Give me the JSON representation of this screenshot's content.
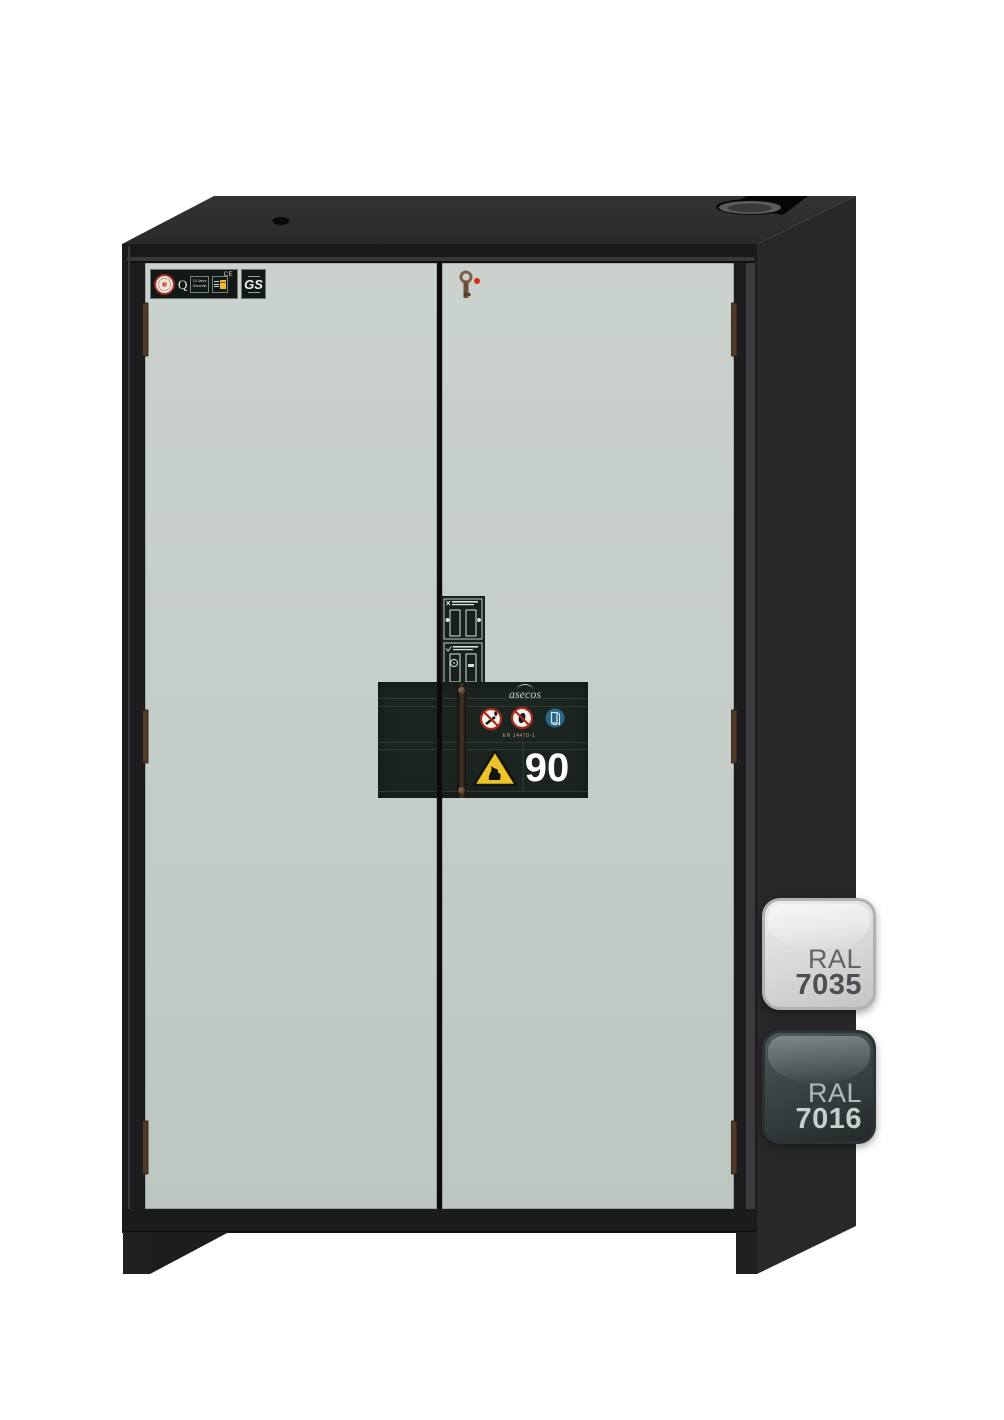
{
  "product": {
    "kind": "fire-resistant safety storage cabinet, front render on white background",
    "colors": {
      "body_anthracite": "#28282b",
      "front_frame": "#1d1d20",
      "door_grey": "#c3cbc7",
      "plinth": "#1b1b1e",
      "type_plate_bg": "#1c2420",
      "warning_yellow": "#edc32a",
      "prohibition_red": "#a8281e",
      "mandatory_blue": "#27688a",
      "key_red_dot": "#d22f12"
    }
  },
  "cert_label": {
    "q_mark": "Q",
    "warranty_line1": "10 Jahre",
    "warranty_line2": "Garantie",
    "ce_mark": "CE",
    "gs_mark": "GS"
  },
  "type_plate": {
    "brand": "asecos",
    "standard": "EN 14470-1",
    "fire_rating": "90",
    "icons": [
      "no-open-flames-icon",
      "no-access-icon",
      "keep-closed-icon",
      "flammable-warning-icon"
    ]
  },
  "door_sticker": {
    "icons": [
      "close-doors-wrong-icon",
      "close-doors-correct-icon"
    ]
  },
  "ral_swatches": [
    {
      "label": "RAL",
      "code": "7035",
      "fill": "#d6d8d7",
      "text_color": "#4b4f55"
    },
    {
      "label": "RAL",
      "code": "7016",
      "fill": "#343d3f",
      "text_color": "#c9cecd"
    }
  ]
}
